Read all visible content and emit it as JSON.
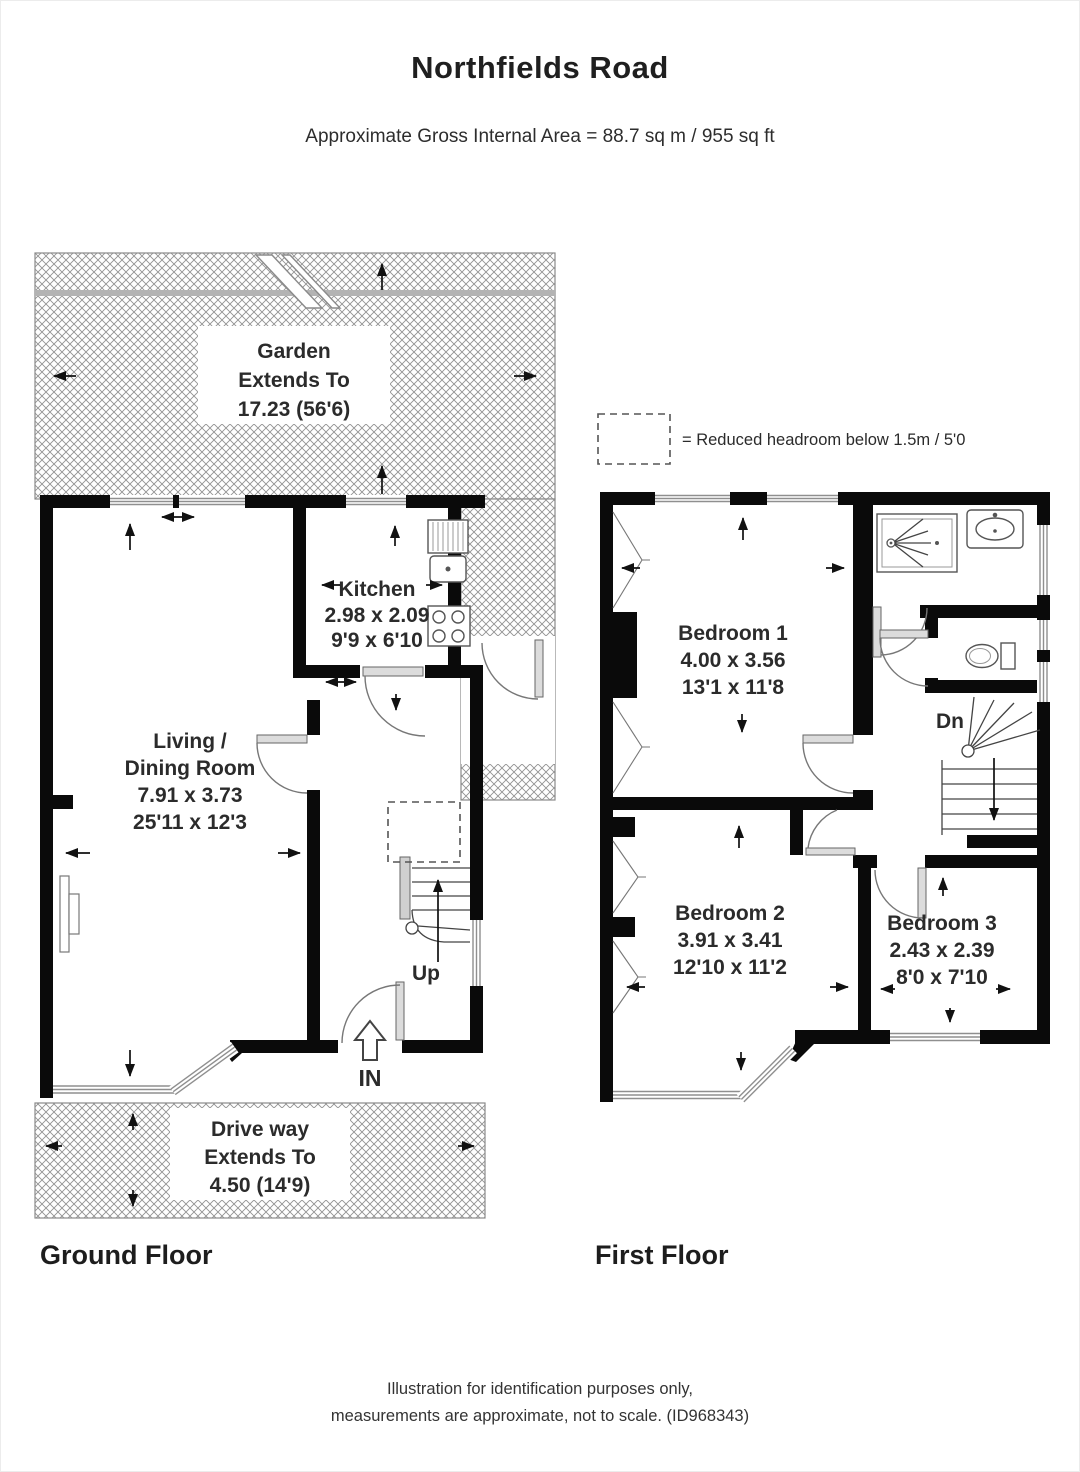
{
  "header": {
    "title": "Northfields Road",
    "subtitle": "Approximate Gross Internal Area = 88.7 sq m / 955 sq ft"
  },
  "legend": {
    "label": "= Reduced headroom below 1.5m / 5'0"
  },
  "ground_floor": {
    "section_label": "Ground Floor",
    "garden": {
      "name": "Garden",
      "extends": "Extends To",
      "dimension": "17.23 (56'6)"
    },
    "kitchen": {
      "name": "Kitchen",
      "metric": "2.98 x 2.09",
      "imperial": "9'9 x 6'10"
    },
    "living_dining": {
      "name_line1": "Living /",
      "name_line2": "Dining Room",
      "metric": "7.91 x 3.73",
      "imperial": "25'11 x 12'3"
    },
    "stairs": {
      "label": "Up"
    },
    "entrance": {
      "label": "IN"
    },
    "driveway": {
      "name": "Drive way",
      "extends": "Extends To",
      "dimension": "4.50 (14'9)"
    }
  },
  "first_floor": {
    "section_label": "First Floor",
    "bedroom1": {
      "name": "Bedroom 1",
      "metric": "4.00 x 3.56",
      "imperial": "13'1 x 11'8"
    },
    "bedroom2": {
      "name": "Bedroom 2",
      "metric": "3.91 x 3.41",
      "imperial": "12'10 x 11'2"
    },
    "bedroom3": {
      "name": "Bedroom 3",
      "metric": "2.43 x 2.39",
      "imperial": "8'0 x 7'10"
    },
    "stairs": {
      "label": "Dn"
    }
  },
  "footer": {
    "line1": "Illustration for identification purposes only,",
    "line2": "measurements are approximate, not to scale. (ID968343)"
  },
  "colors": {
    "wall": "#0a0a0a",
    "hatch_line": "#8f8f8f",
    "text": "#2d2d2d"
  }
}
